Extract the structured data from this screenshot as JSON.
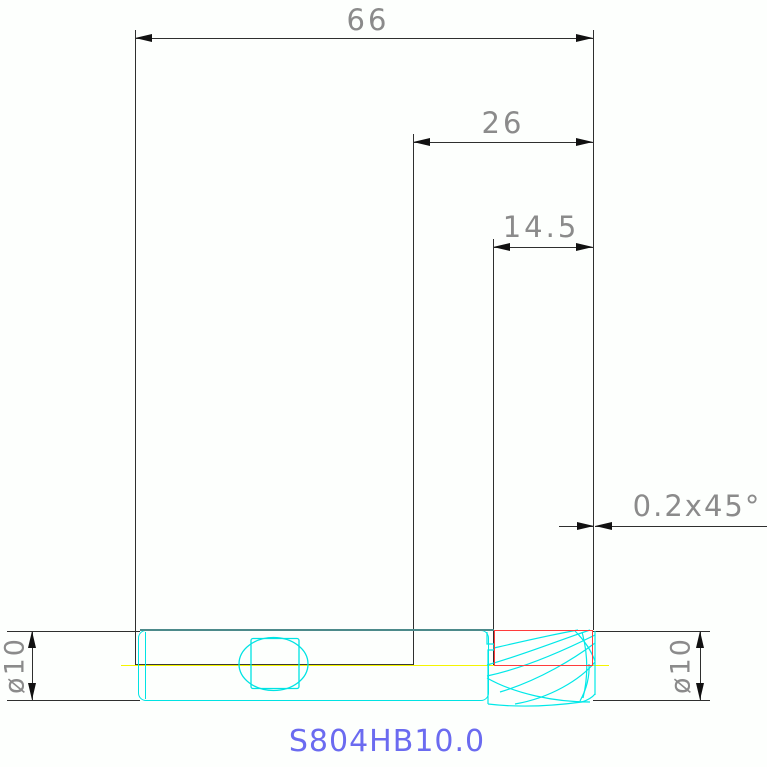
{
  "drawing": {
    "title": "S804HB10.0",
    "dimensions": {
      "overall_length": "66",
      "exposed_length": "26",
      "flute_length": "14.5",
      "tip_chamfer": "0.2x45°",
      "shank_diameter": "ø10",
      "cutting_diameter": "ø10"
    },
    "colors": {
      "tool_outline": "#00e3e3",
      "shank_top_edge": "#4c8a8a",
      "cutting_zone_box": "#ff3b3b",
      "centerline": "#f5f500",
      "dimension_lines": "#2f2f2f",
      "dimension_text": "#8b8b8b",
      "title_text": "#6b6bf0"
    }
  }
}
